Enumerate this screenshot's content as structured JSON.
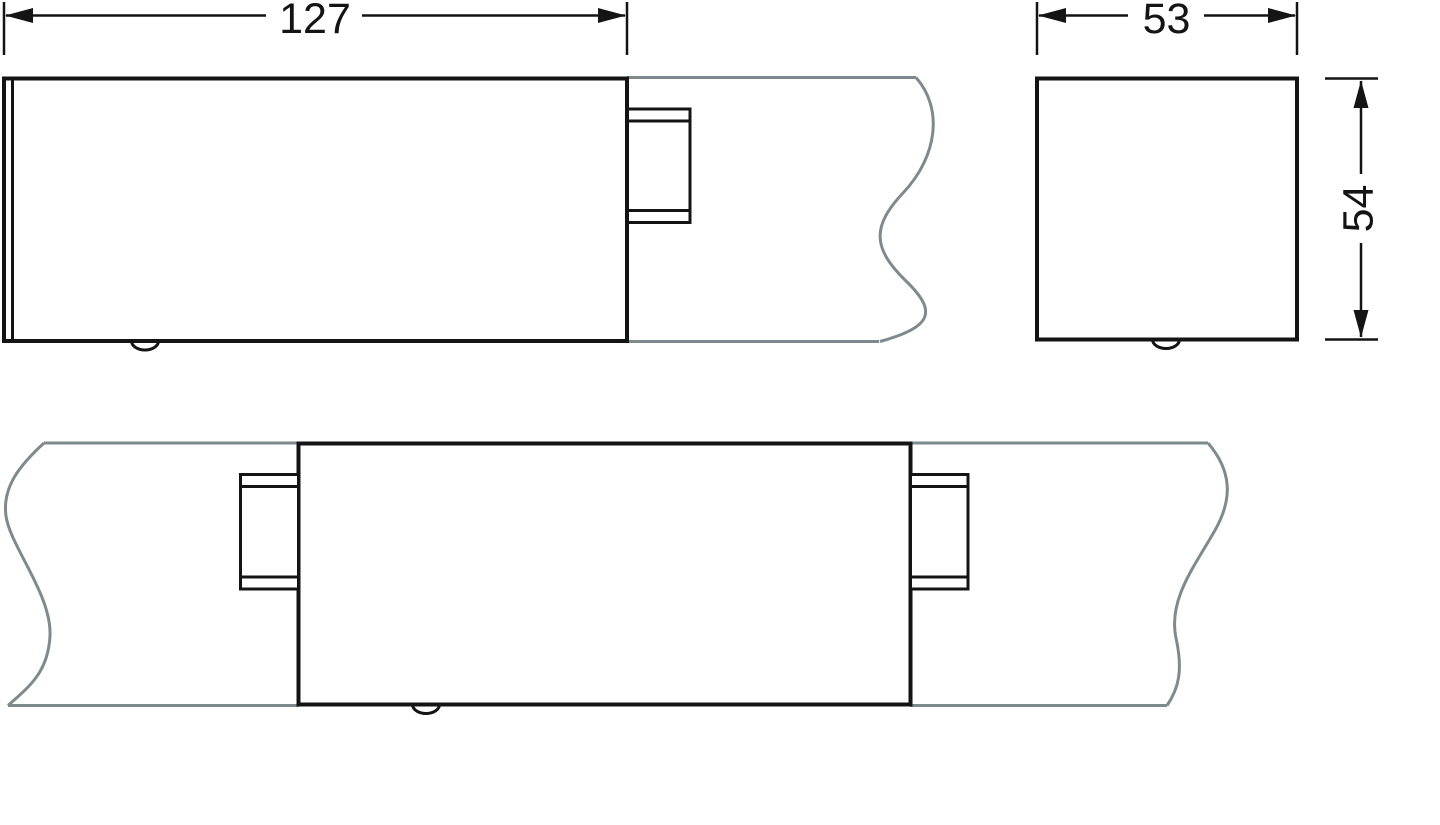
{
  "dimensions": {
    "length": "127",
    "width": "53",
    "height": "54"
  },
  "colors": {
    "part_outline": "#141414",
    "duct_break_line": "#7e8a8e",
    "background": "#ffffff"
  }
}
